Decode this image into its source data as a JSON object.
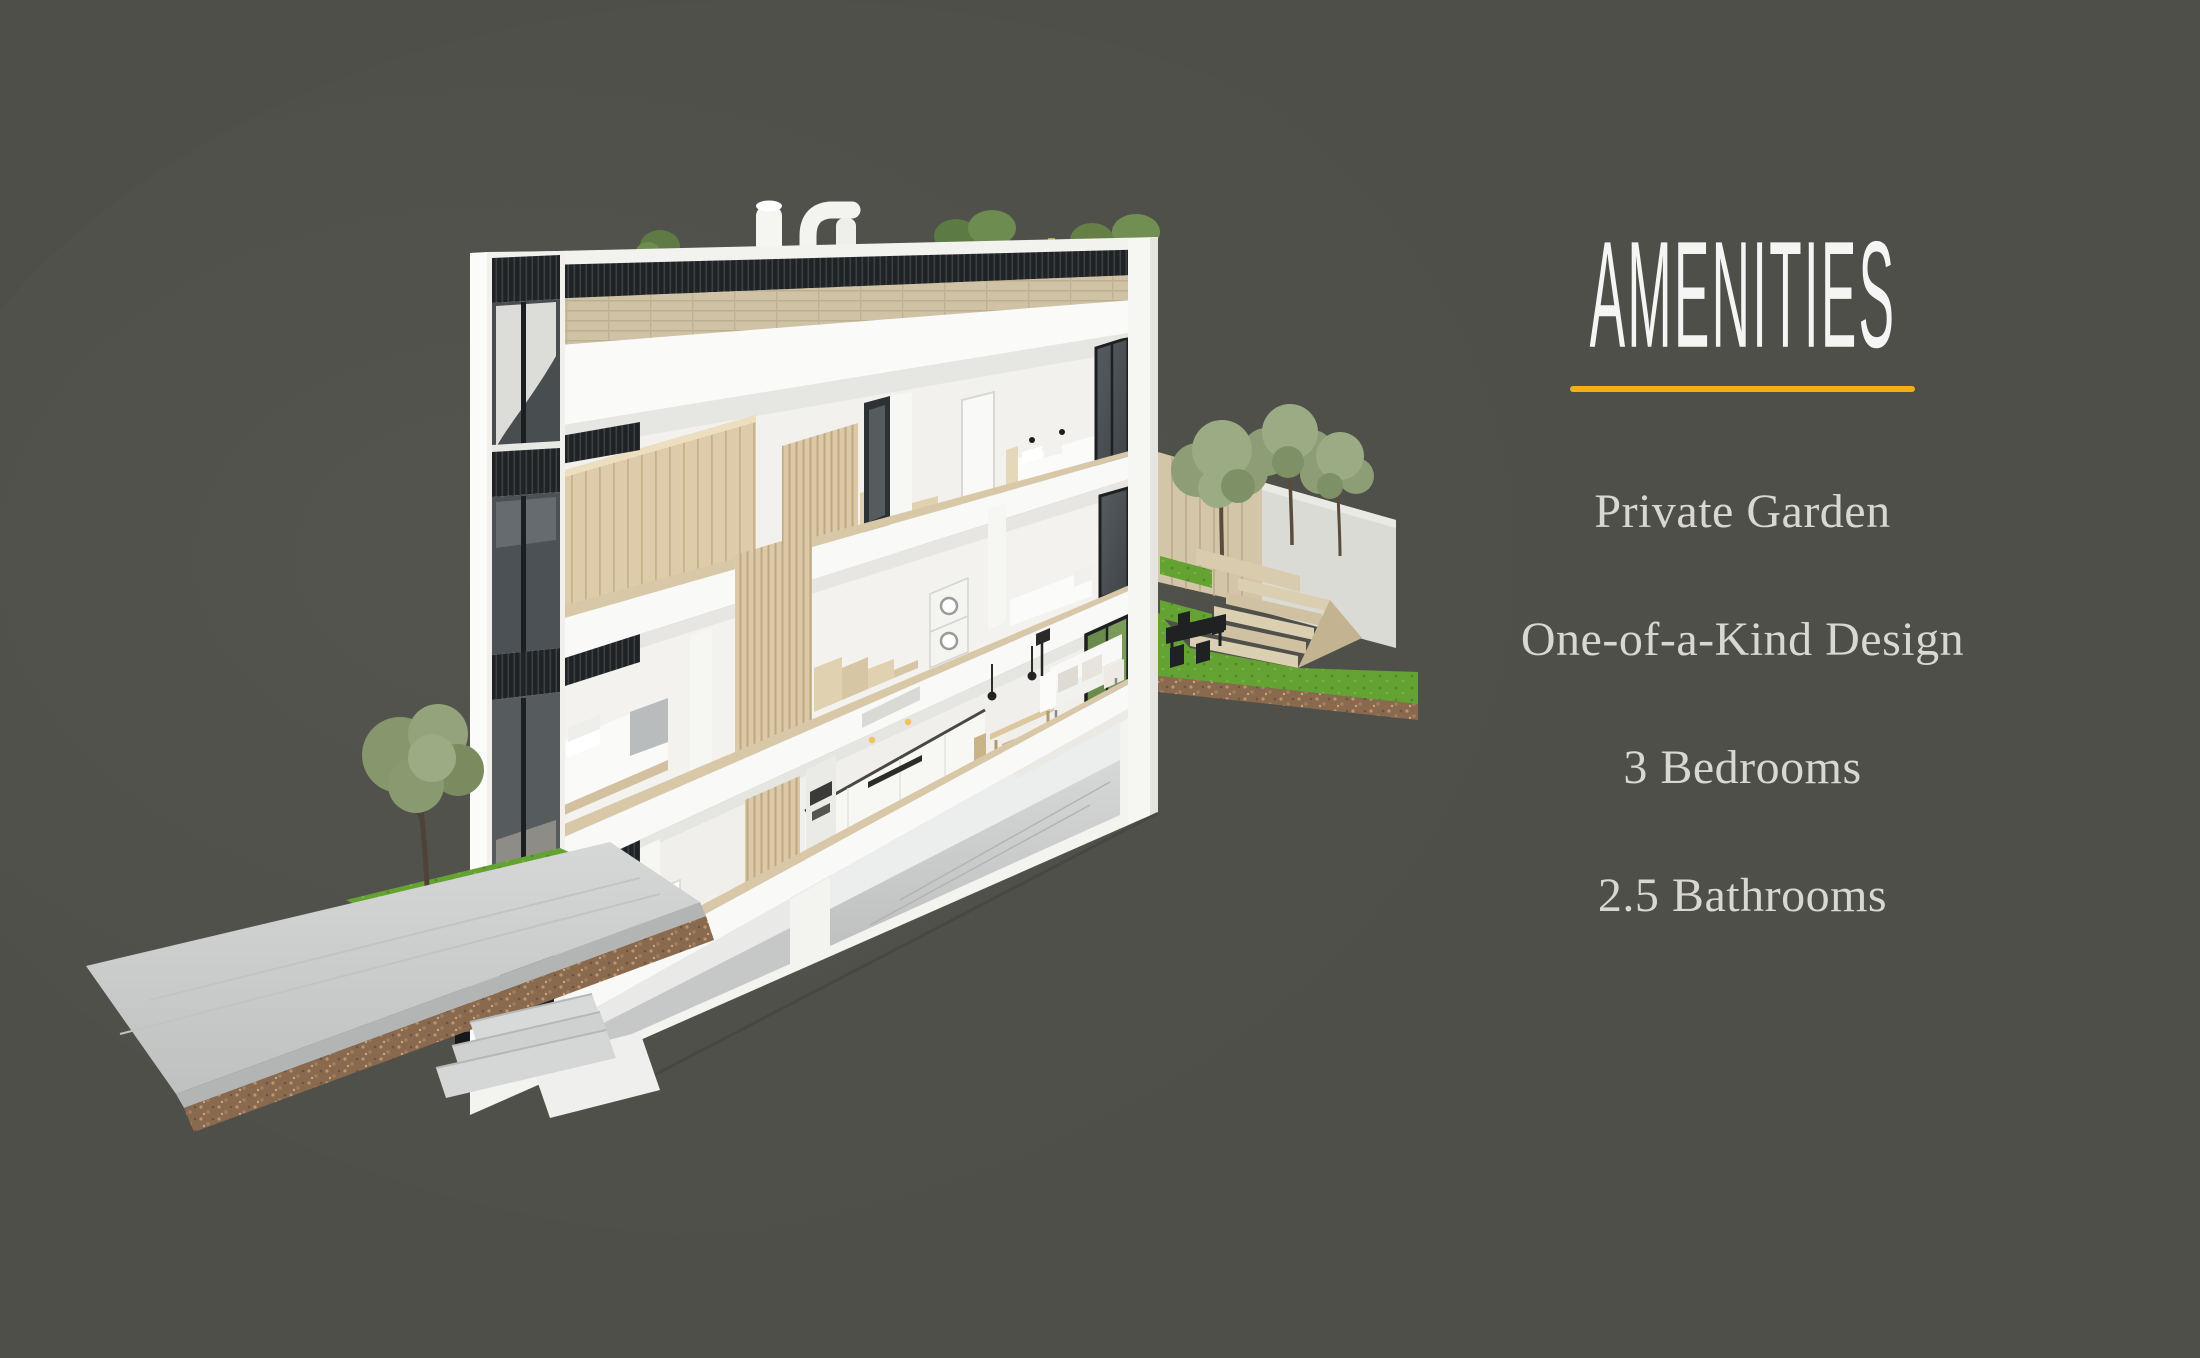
{
  "background_color": "#4f4f4a",
  "panel": {
    "title": "AMENITIES",
    "title_color": "#f5f5f3",
    "accent_color": "#f0b114",
    "item_color": "#d8d7d2",
    "items": [
      {
        "label": "Private Garden"
      },
      {
        "label": "One-of-a-Kind Design"
      },
      {
        "label": "3 Bedrooms"
      },
      {
        "label": "2.5 Bathrooms"
      }
    ]
  },
  "illustration": {
    "subject": "3D cutaway cross-section of a three-storey townhouse",
    "elements": [
      "rooftop-terrace-with-planters-and-vents",
      "third-floor-bedroom-and-wardrobe",
      "second-floor-bedroom-laundry-stairs",
      "ground-floor-kitchen-dining-living",
      "basement",
      "private-garden-with-trees-and-terraced-steps",
      "street-entrance-with-stoop-tree-and-sidewalk"
    ]
  }
}
